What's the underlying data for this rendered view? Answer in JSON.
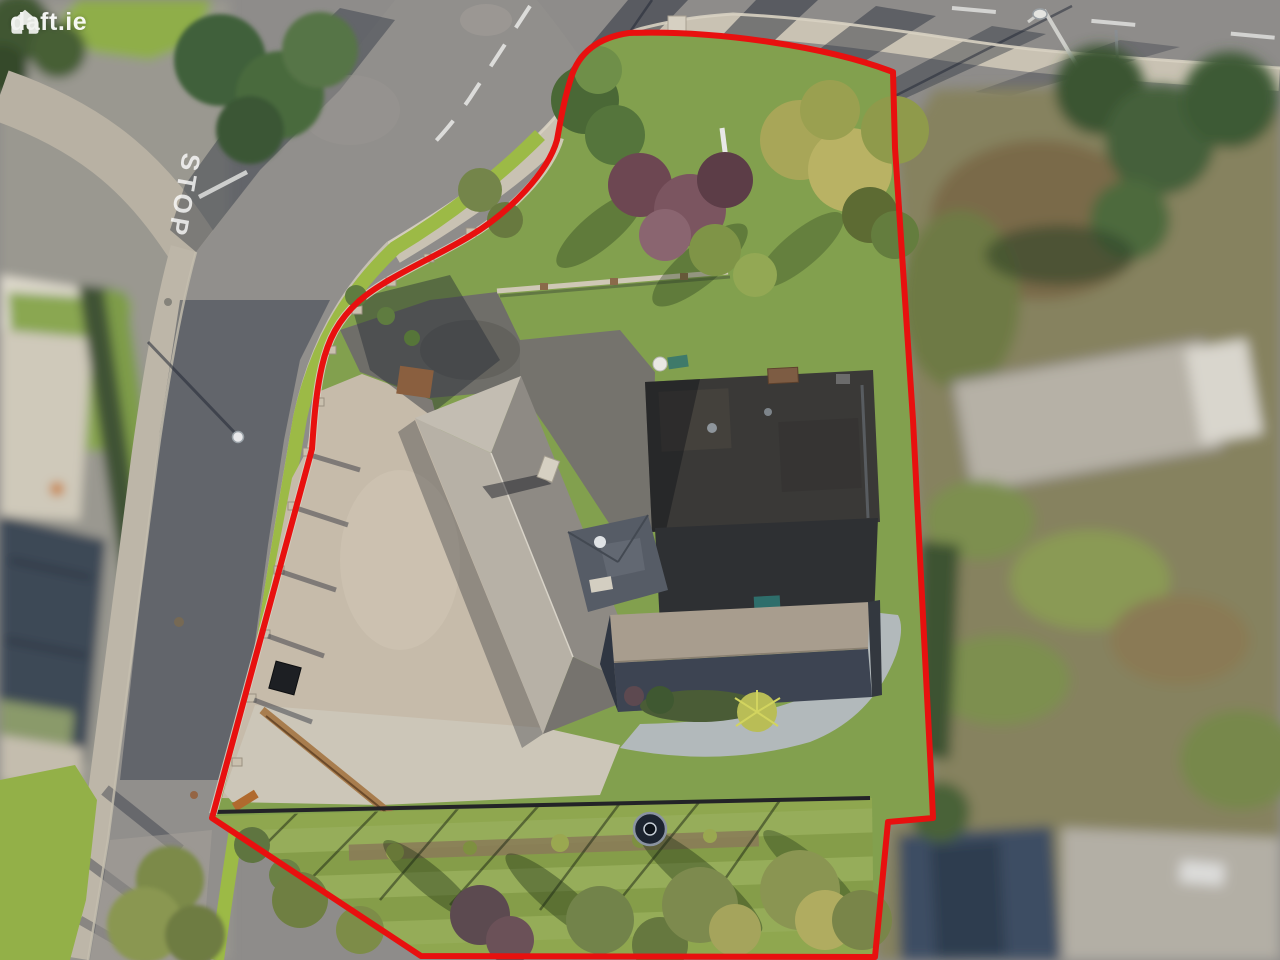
{
  "watermark": {
    "logo_text": "daft.ie"
  },
  "road_markings": {
    "stop_text": "STOP"
  },
  "colors": {
    "boundary_red": "#e8100f",
    "asphalt": "#8e8c8a",
    "sidewalk": "#c9c2b3",
    "grass_verge": "#9cba46",
    "lawn": "#82a04e",
    "gravel": "#c6bbaa",
    "roof_light": "#b7b1a6",
    "roof_slate_dark": "#3d4452",
    "flat_roof": "#3a3937"
  }
}
